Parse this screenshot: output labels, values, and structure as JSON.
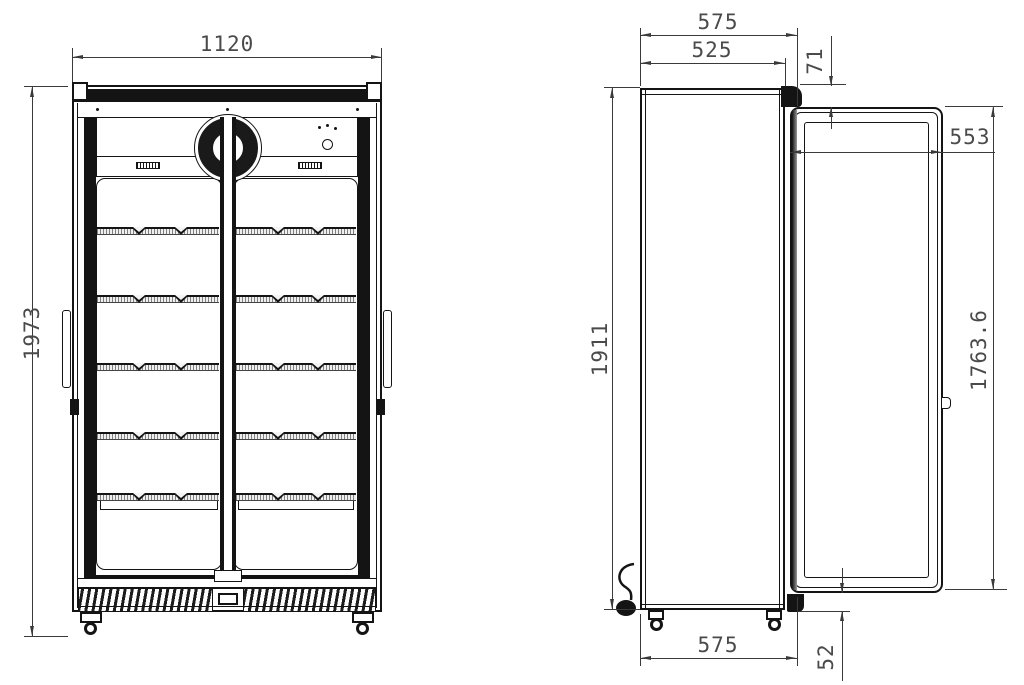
{
  "dims": {
    "front_width": "1120",
    "front_height": "1973",
    "overall_depth": "575",
    "body_depth": "525",
    "door_top_offset": "71",
    "door_width": "553",
    "body_height": "1911",
    "door_height": "1763.6",
    "base_depth": "575",
    "door_bottom_clearance": "52"
  }
}
